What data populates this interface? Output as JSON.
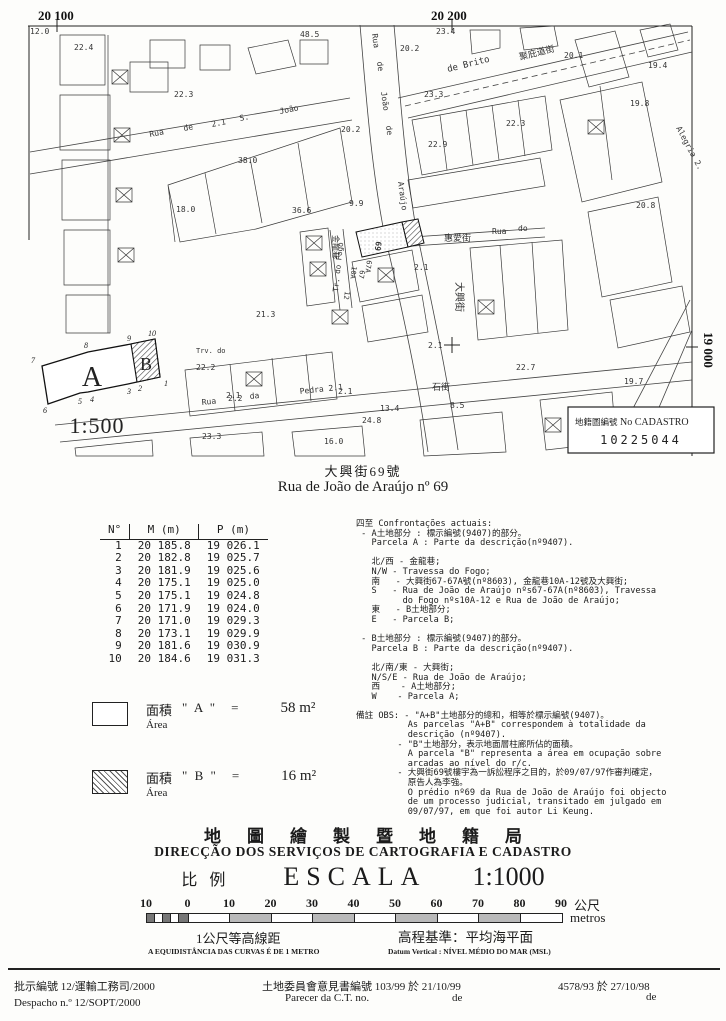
{
  "map": {
    "grid": {
      "top_left": "20 100",
      "top_right": "20 200",
      "right": "19 000"
    },
    "cadastro": {
      "label_zh": "地籍圖編號",
      "label_pt": "No CADASTRO",
      "number": "10225044"
    },
    "labels": [
      "Rua",
      "de",
      "2.1",
      "S.",
      "João",
      "Rua",
      "de",
      "João",
      "de",
      "Araújo",
      "de Brito",
      "聚庇道街",
      "惠愛街",
      "Rua",
      "do",
      "大興街",
      "Tr. do Fogo",
      "金龍巷",
      "石街",
      "Rua",
      "da",
      "Pedra 2.1",
      "Alegria 2.",
      "69",
      "67A",
      "67",
      "10A",
      "12",
      "Trv. do",
      "2.1",
      "2.1",
      "2.1",
      "2.1"
    ],
    "heights": [
      "12.0",
      "22.4",
      "48.5",
      "23.4",
      "20.2",
      "22.3",
      "23.3",
      "20.1",
      "19.4",
      "19.8",
      "22.3",
      "22.9",
      "20.2",
      "38.0",
      "36.6",
      "9.9",
      "18.0",
      "20.8",
      "19.7",
      "22.7",
      "21.3",
      "22.2",
      "23.3",
      "24.8",
      "13.4",
      "8.5",
      "16.0",
      "2.2"
    ]
  },
  "inset": {
    "a": "A",
    "b": "B",
    "scale": "1:500",
    "vertices": [
      "1",
      "2",
      "3",
      "4",
      "5",
      "6",
      "7",
      "8",
      "9",
      "10"
    ]
  },
  "title": {
    "zh": "大興街69號",
    "pt": "Rua de João de Araújo nº 69"
  },
  "table": {
    "headers": [
      "N°",
      "M (m)",
      "P (m)"
    ],
    "rows": [
      [
        "1",
        "20 185.8",
        "19 026.1"
      ],
      [
        "2",
        "20 182.8",
        "19 025.7"
      ],
      [
        "3",
        "20 181.9",
        "19 025.6"
      ],
      [
        "4",
        "20 175.1",
        "19 025.0"
      ],
      [
        "5",
        "20 175.1",
        "19 024.8"
      ],
      [
        "6",
        "20 171.9",
        "19 024.0"
      ],
      [
        "7",
        "20 171.0",
        "19 029.3"
      ],
      [
        "8",
        "20 173.1",
        "19 029.9"
      ],
      [
        "9",
        "20 181.6",
        "19 030.9"
      ],
      [
        "10",
        "20 184.6",
        "19 031.3"
      ]
    ]
  },
  "confrontations": "四至 Confrontações actuais:\n - A土地部分 : 標示編號(9407)的部分。\n   Parcela A : Parte da descrição(nº9407).\n\n   北/西 - 金龍巷;\n   N/W - Travessa do Fogo;\n   南   - 大興街67-67A號(nº8603), 金龍巷10A-12號及大興街;\n   S   - Rua de João de Araújo nºs67-67A(nº8603), Travessa\n         do Fogo nºs10A-12 e Rua de João de Araújo;\n   東   - B土地部分;\n   E   - Parcela B;\n\n - B土地部分 : 標示編號(9407)的部分。\n   Parcela B : Parte da descrição(nº9407).\n\n   北/南/東 - 大興街;\n   N/S/E - Rua de João de Araújo;\n   西    - A土地部分;\n   W    - Parcela A;\n\n備註 OBS: - \"A+B\"土地部分的總和，相等於標示編號(9407)。\n          As parcelas \"A+B\" correspondem à totalidade da\n          descrição (nº9407).\n        - \"B\"土地部分，表示地面層柱廊所佔的面積。\n          A parcela \"B\" representa a área em ocupação sobre\n          arcadas ao nível do r/c.\n        - 大興街69號樓宇為一訴訟程序之目的，於09/07/97作審判確定，\n          原告人為李強。\n          O prédio nº69 da Rua de João de Araújo foi objecto\n          de um processo judicial, transitado em julgado em\n          09/07/97, em que foi autor Li Keung.",
  "legend": {
    "items": [
      {
        "zh": "面積",
        "pt": "Área",
        "name": "\" A \"",
        "eq": "=",
        "value": "58 m²"
      },
      {
        "zh": "面積",
        "pt": "Área",
        "name": "\" B \"",
        "eq": "=",
        "value": "16 m²"
      }
    ]
  },
  "agency": {
    "zh": "地圖繪製暨地籍局",
    "pt": "DIRECÇÃO DOS SERVIÇOS DE CARTOGRAFIA E CADASTRO",
    "scale_zh": "比例",
    "scale_word": "ESCALA",
    "scale_value": "1:1000"
  },
  "scalebar": {
    "ticks": [
      "10",
      "0",
      "10",
      "20",
      "30",
      "40",
      "50",
      "60",
      "70",
      "80",
      "90"
    ],
    "unit_zh": "公尺",
    "unit_pt": "metros",
    "contour_zh": "1公尺等高線距",
    "contour_pt": "A EQUIDISTÂNCIA DAS CURVAS É DE 1 METRO",
    "datum_zh": "高程基準：平均海平面",
    "datum_pt": "Datum Vertical : NÍVEL MÉDIO DO MAR (MSL)"
  },
  "footer": {
    "despacho_zh": "批示編號 12/運輸工務司/2000",
    "despacho_pt": "Despacho n.º 12/SOPT/2000",
    "parecer_zh": "土地委員會意見書編號 103/99 於 21/10/99",
    "parecer_pt": "Parecer da C.T. no.",
    "parecer_de": "de",
    "right_no": "4578/93 於 27/10/98",
    "right_de": "de"
  }
}
